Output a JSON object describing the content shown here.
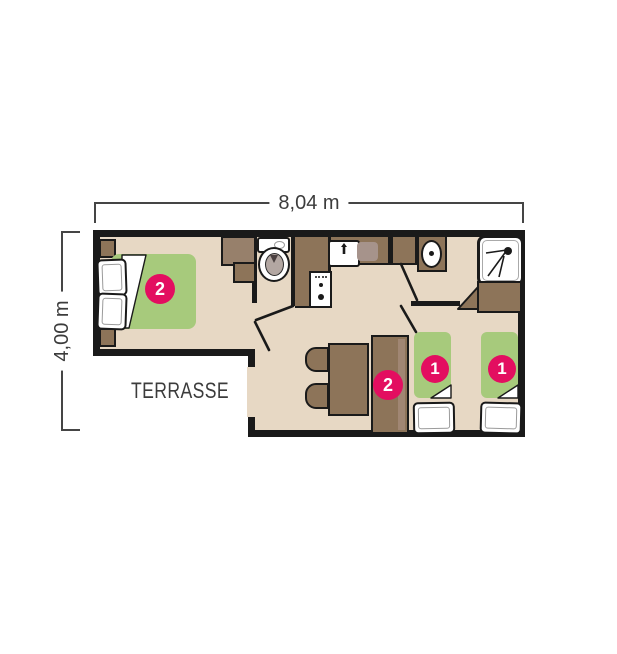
{
  "floorplan": {
    "dimensions": {
      "width_label": "8,04 m",
      "height_label": "4,00 m"
    },
    "terrace_label": "TERRASSE",
    "badges": [
      {
        "area": "double-bed",
        "value": "2"
      },
      {
        "area": "sofa-bunk",
        "value": "2"
      },
      {
        "area": "single-bed-left",
        "value": "1"
      },
      {
        "area": "single-bed-right",
        "value": "1"
      }
    ],
    "icons": [
      "toilet-icon",
      "washbasin-icon",
      "shower-icon",
      "faucet-icon",
      "stove-icon"
    ],
    "colors": {
      "wall": "#1a1a1a",
      "floor": "#e7d8c4",
      "furniture_brown": "#8d7459",
      "furniture_light_brown": "#a08673",
      "drainer_gray": "#a6938b",
      "bed_green": "#a7ca7c",
      "badge_pink": "#e30e60",
      "dimension_gray": "#454545",
      "text_gray": "#3c3c3c"
    }
  }
}
